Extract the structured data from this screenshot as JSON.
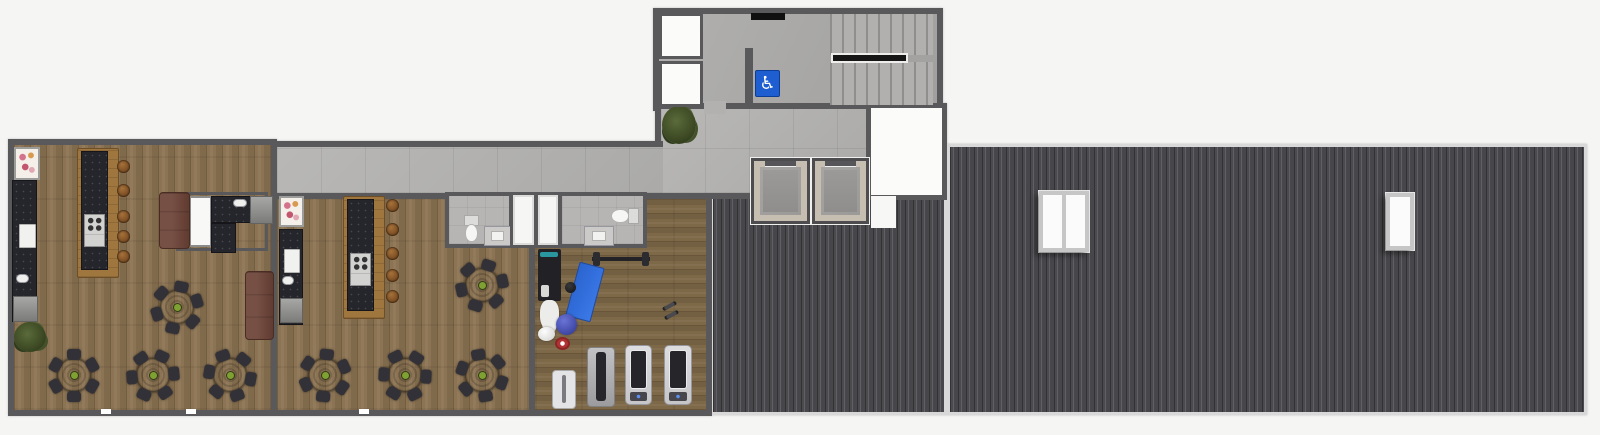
{
  "meta": {
    "scene": "residential-amenity-floor-plan-render",
    "areas": [
      "lounge-west",
      "lounge-center",
      "gym",
      "corridor",
      "elevator-lobby",
      "stair-tower",
      "storage-rooms",
      "bathrooms",
      "shower-stalls",
      "utility-room",
      "metal-roof"
    ]
  },
  "signs": {
    "accessible": "♿"
  },
  "palette": {
    "wall": "#59595b",
    "wood": "#8b7353",
    "woodDark": "#7d6848",
    "tile": "#b4b3b1",
    "concrete": "#abaaa8",
    "roof": "#404043",
    "roofRib": "#606065",
    "granite": "#25252c",
    "islandWood": "#a0763f",
    "table": "#6b2715",
    "tableEdge": "#541d0e",
    "bowl": "#7fa032",
    "chair": "#323137",
    "sofa": "#6d4337",
    "stool": "#a5713a",
    "matBlue": "#2a64cf",
    "signBlue": "#1e5ed1",
    "elevatorFrame": "#c5beb1",
    "skylight": "#fbfbfb",
    "plant": "#5b6b3a",
    "flowerPink": "#d4728c",
    "flowerOrange": "#d89a4e",
    "teal": "#2a97a0",
    "ballBlue": "#2d3590",
    "belt": "#26262a",
    "cabinet": "#a7a7a5"
  },
  "elements": [
    {
      "type": "shelf",
      "name": "flower-shelf",
      "x": 14,
      "y": 147,
      "w": 26,
      "h": 33
    },
    {
      "type": "granite",
      "name": "kitchen-wall-counter",
      "x": 12,
      "y": 180,
      "w": 25,
      "h": 142
    },
    {
      "type": "fridge",
      "name": "fridge",
      "x": 19,
      "y": 224,
      "w": 17,
      "h": 24
    },
    {
      "type": "sink",
      "name": "kitchen-sink",
      "x": 16,
      "y": 274,
      "w": 13,
      "h": 9
    },
    {
      "type": "cabinet",
      "name": "cabinet",
      "x": 13,
      "y": 296,
      "w": 25,
      "h": 26
    },
    {
      "type": "plant",
      "name": "potted-plant",
      "x": 14,
      "y": 322,
      "w": 32,
      "h": 30
    },
    {
      "type": "woodbar",
      "name": "kitchen-island",
      "x": 77,
      "y": 148,
      "w": 42,
      "h": 130
    },
    {
      "type": "granite",
      "name": "island-countertop",
      "x": 81,
      "y": 151,
      "w": 27,
      "h": 119
    },
    {
      "type": "stove",
      "name": "stove",
      "x": 84,
      "y": 214,
      "w": 21,
      "h": 33
    },
    {
      "type": "stool",
      "name": "bar-stool",
      "x": 117,
      "y": 160,
      "w": 13,
      "h": 13
    },
    {
      "type": "stool",
      "name": "bar-stool",
      "x": 117,
      "y": 184,
      "w": 13,
      "h": 13
    },
    {
      "type": "stool",
      "name": "bar-stool",
      "x": 117,
      "y": 210,
      "w": 13,
      "h": 13
    },
    {
      "type": "stool",
      "name": "bar-stool",
      "x": 117,
      "y": 230,
      "w": 13,
      "h": 13
    },
    {
      "type": "stool",
      "name": "bar-stool",
      "x": 117,
      "y": 250,
      "w": 13,
      "h": 13
    },
    {
      "type": "wallbox",
      "name": "bath-nook-wall",
      "x": 176,
      "y": 192,
      "w": 92,
      "h": 59
    },
    {
      "type": "closet",
      "name": "shower-closet",
      "x": 189,
      "y": 196,
      "w": 23,
      "h": 51
    },
    {
      "type": "granite",
      "name": "bath-counter",
      "x": 211,
      "y": 196,
      "w": 42,
      "h": 27
    },
    {
      "type": "granite",
      "name": "bath-counter",
      "x": 211,
      "y": 223,
      "w": 25,
      "h": 30
    },
    {
      "type": "sink",
      "name": "bath-sink",
      "x": 233,
      "y": 199,
      "w": 14,
      "h": 8
    },
    {
      "type": "cabinet",
      "name": "cabinet",
      "x": 250,
      "y": 196,
      "w": 23,
      "h": 28
    },
    {
      "type": "sofa",
      "name": "sofa",
      "x": 159,
      "y": 192,
      "w": 31,
      "h": 57
    },
    {
      "type": "sofa",
      "name": "sofa",
      "x": 245,
      "y": 271,
      "w": 29,
      "h": 69
    },
    {
      "type": "table",
      "name": "dining-table",
      "x": 153,
      "y": 283,
      "w": 48,
      "h": 48,
      "rot": 12
    },
    {
      "type": "table",
      "name": "dining-table",
      "x": 50,
      "y": 351,
      "w": 48,
      "h": 48,
      "rot": 0
    },
    {
      "type": "table",
      "name": "dining-table",
      "x": 129,
      "y": 351,
      "w": 48,
      "h": 48,
      "rot": 25
    },
    {
      "type": "table",
      "name": "dining-table",
      "x": 206,
      "y": 351,
      "w": 48,
      "h": 48,
      "rot": 40
    },
    {
      "type": "shelf",
      "name": "flower-shelf",
      "x": 279,
      "y": 196,
      "w": 25,
      "h": 31
    },
    {
      "type": "granite",
      "name": "kitchen-wall-counter",
      "x": 279,
      "y": 229,
      "w": 24,
      "h": 96
    },
    {
      "type": "fridge",
      "name": "fridge",
      "x": 284,
      "y": 249,
      "w": 16,
      "h": 24
    },
    {
      "type": "sink",
      "name": "kitchen-sink",
      "x": 282,
      "y": 276,
      "w": 12,
      "h": 9
    },
    {
      "type": "cabinet",
      "name": "cabinet",
      "x": 280,
      "y": 298,
      "w": 23,
      "h": 25
    },
    {
      "type": "woodbar",
      "name": "kitchen-island",
      "x": 343,
      "y": 196,
      "w": 42,
      "h": 123
    },
    {
      "type": "granite",
      "name": "island-countertop",
      "x": 347,
      "y": 199,
      "w": 27,
      "h": 112
    },
    {
      "type": "stove",
      "name": "stove",
      "x": 350,
      "y": 253,
      "w": 21,
      "h": 33
    },
    {
      "type": "stool",
      "name": "bar-stool",
      "x": 386,
      "y": 199,
      "w": 13,
      "h": 13
    },
    {
      "type": "stool",
      "name": "bar-stool",
      "x": 386,
      "y": 223,
      "w": 13,
      "h": 13
    },
    {
      "type": "stool",
      "name": "bar-stool",
      "x": 386,
      "y": 247,
      "w": 13,
      "h": 13
    },
    {
      "type": "stool",
      "name": "bar-stool",
      "x": 386,
      "y": 269,
      "w": 13,
      "h": 13
    },
    {
      "type": "stool",
      "name": "bar-stool",
      "x": 386,
      "y": 290,
      "w": 13,
      "h": 13
    },
    {
      "type": "table",
      "name": "dining-table",
      "x": 458,
      "y": 261,
      "w": 48,
      "h": 48,
      "rot": 18
    },
    {
      "type": "table",
      "name": "dining-table",
      "x": 301,
      "y": 351,
      "w": 48,
      "h": 48,
      "rot": 5
    },
    {
      "type": "table",
      "name": "dining-table",
      "x": 381,
      "y": 351,
      "w": 48,
      "h": 48,
      "rot": 33
    },
    {
      "type": "table",
      "name": "dining-table",
      "x": 458,
      "y": 351,
      "w": 48,
      "h": 48,
      "rot": 50
    },
    {
      "type": "bath",
      "name": "bathroom",
      "x": 445,
      "y": 192,
      "w": 68,
      "h": 56
    },
    {
      "type": "toiletv",
      "name": "toilet",
      "x": 462,
      "y": 215,
      "w": 17,
      "h": 28
    },
    {
      "type": "vanity",
      "name": "bath-vanity",
      "x": 484,
      "y": 226,
      "w": 27,
      "h": 20
    },
    {
      "type": "stall",
      "name": "shower-stall",
      "x": 510,
      "y": 192,
      "w": 27,
      "h": 56
    },
    {
      "type": "stall",
      "name": "shower-stall",
      "x": 535,
      "y": 192,
      "w": 26,
      "h": 56
    },
    {
      "type": "bath",
      "name": "bathroom",
      "x": 558,
      "y": 192,
      "w": 89,
      "h": 56
    },
    {
      "type": "toileth",
      "name": "toilet",
      "x": 610,
      "y": 206,
      "w": 29,
      "h": 18
    },
    {
      "type": "vanity",
      "name": "bath-vanity",
      "x": 584,
      "y": 226,
      "w": 30,
      "h": 20
    },
    {
      "type": "rack",
      "name": "weight-station",
      "x": 538,
      "y": 249,
      "w": 23,
      "h": 52
    },
    {
      "type": "barbell",
      "name": "barbell-rack",
      "x": 592,
      "y": 250,
      "w": 58,
      "h": 18
    },
    {
      "type": "mat",
      "name": "exercise-mat",
      "x": 572,
      "y": 264,
      "w": 26,
      "h": 56,
      "rot": 15
    },
    {
      "type": "kettlebell",
      "name": "kettlebell",
      "x": 565,
      "y": 282,
      "w": 11,
      "h": 11
    },
    {
      "type": "pads",
      "name": "floor-pads",
      "x": 540,
      "y": 300,
      "w": 19,
      "h": 30
    },
    {
      "type": "ball",
      "name": "exercise-ball",
      "x": 556,
      "y": 314,
      "w": 21,
      "h": 21
    },
    {
      "type": "ball",
      "name": "exercise-ball",
      "v": "white",
      "x": 538,
      "y": 327,
      "w": 17,
      "h": 14
    },
    {
      "type": "wheel",
      "name": "ab-wheel",
      "x": 555,
      "y": 337,
      "w": 15,
      "h": 13
    },
    {
      "type": "dumbbells",
      "name": "dumbbells",
      "x": 662,
      "y": 301,
      "w": 18,
      "h": 22
    },
    {
      "type": "rower",
      "name": "rowing-machine",
      "x": 552,
      "y": 370,
      "w": 24,
      "h": 39
    },
    {
      "type": "bench",
      "name": "weight-bench",
      "x": 587,
      "y": 347,
      "w": 28,
      "h": 60
    },
    {
      "type": "treadmill",
      "name": "treadmill",
      "x": 625,
      "y": 345,
      "w": 27,
      "h": 60
    },
    {
      "type": "treadmill",
      "name": "treadmill",
      "x": 664,
      "y": 345,
      "w": 28,
      "h": 60
    },
    {
      "type": "plant",
      "name": "potted-plant",
      "x": 662,
      "y": 106,
      "w": 34,
      "h": 38
    },
    {
      "type": "vent",
      "name": "wall-vent",
      "x": 751,
      "y": 13,
      "w": 34,
      "h": 7
    },
    {
      "type": "sign",
      "name": "accessible-sign",
      "x": 756,
      "y": 71,
      "w": 23,
      "h": 25
    },
    {
      "type": "store",
      "name": "storage-room",
      "x": 659,
      "y": 13,
      "w": 44,
      "h": 46
    },
    {
      "type": "store",
      "name": "storage-room",
      "x": 659,
      "y": 61,
      "w": 44,
      "h": 46
    },
    {
      "type": "flight",
      "name": "stair-flight-upper",
      "x": 830,
      "y": 14,
      "w": 103,
      "h": 41
    },
    {
      "type": "flight",
      "name": "stair-flight-lower",
      "x": 830,
      "y": 62,
      "w": 103,
      "h": 43
    },
    {
      "type": "rail",
      "name": "stair-rail",
      "x": 831,
      "y": 53,
      "w": 77,
      "h": 10
    },
    {
      "type": "stub",
      "name": "lobby-wall",
      "x": 745,
      "y": 48,
      "w": 8,
      "h": 58
    },
    {
      "type": "gap",
      "name": "door-opening",
      "x": 704,
      "y": 101,
      "w": 22,
      "h": 13
    },
    {
      "type": "elevator",
      "name": "elevator",
      "x": 751,
      "y": 158,
      "w": 59,
      "h": 66
    },
    {
      "type": "elevator",
      "name": "elevator",
      "x": 812,
      "y": 158,
      "w": 57,
      "h": 66
    },
    {
      "type": "notch",
      "name": "roof-notch",
      "x": 871,
      "y": 196,
      "w": 25,
      "h": 32
    },
    {
      "type": "skylight",
      "name": "skylight",
      "v": "p2",
      "x": 1039,
      "y": 191,
      "w": 50,
      "h": 61
    },
    {
      "type": "skylight",
      "name": "skylight",
      "v": "p1",
      "x": 1386,
      "y": 193,
      "w": 28,
      "h": 57
    },
    {
      "type": "win",
      "name": "window-marker",
      "x": 101,
      "y": 409,
      "w": 10,
      "h": 5
    },
    {
      "type": "win",
      "name": "window-marker",
      "x": 186,
      "y": 409,
      "w": 10,
      "h": 5
    },
    {
      "type": "win",
      "name": "window-marker",
      "x": 359,
      "y": 409,
      "w": 10,
      "h": 5
    }
  ]
}
